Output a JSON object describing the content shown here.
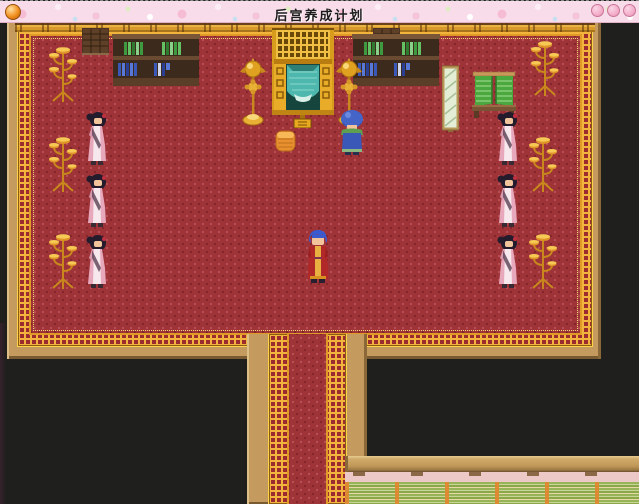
{
  "window": {
    "title": "后宫养成计划"
  },
  "palette": {
    "titlebar_pink": "#f9dcea",
    "ball_orange": "#f29020",
    "carpet_red": "#9e3338",
    "gold_trim": "#f2b43c",
    "wall_tan": "#c49a5e",
    "void_black": "#1f1f1d",
    "curtain_teal": "#4fb8ae",
    "mat_green": "#98b458",
    "lower_wall_pink": "#ecc9c6",
    "post_orange": "#e08830"
  },
  "scene": {
    "name": "palace-hall-interior",
    "entities": [
      {
        "type": "wallpanel",
        "name": "wall-panel",
        "x": 82,
        "y": 5
      },
      {
        "type": "wallpanel",
        "name": "wall-panel",
        "x": 373,
        "y": 5
      },
      {
        "type": "bookshelf",
        "name": "bookshelf",
        "x": 112,
        "y": 11
      },
      {
        "type": "bookshelf",
        "name": "bookshelf",
        "x": 352,
        "y": 11
      },
      {
        "type": "shrine",
        "name": "altar-shrine",
        "x": 272,
        "y": 5
      },
      {
        "type": "goldlamp",
        "name": "golden-lamp",
        "x": 240,
        "y": 35
      },
      {
        "type": "goldlamp",
        "name": "golden-lamp",
        "x": 336,
        "y": 35
      },
      {
        "type": "mirror",
        "name": "standing-mirror",
        "x": 442,
        "y": 41
      },
      {
        "type": "rack",
        "name": "clothes-rack",
        "x": 472,
        "y": 48
      },
      {
        "type": "candelabra",
        "name": "candelabra",
        "x": 46,
        "y": 21
      },
      {
        "type": "candelabra",
        "name": "candelabra",
        "x": 528,
        "y": 15
      },
      {
        "type": "candelabra",
        "name": "candelabra",
        "x": 46,
        "y": 111
      },
      {
        "type": "candelabra",
        "name": "candelabra",
        "x": 526,
        "y": 111
      },
      {
        "type": "candelabra",
        "name": "candelabra",
        "x": 46,
        "y": 208
      },
      {
        "type": "candelabra",
        "name": "candelabra",
        "x": 526,
        "y": 208
      },
      {
        "type": "maid",
        "name": "palace-maid",
        "x": 85,
        "y": 88
      },
      {
        "type": "maid",
        "name": "palace-maid",
        "x": 496,
        "y": 88
      },
      {
        "type": "maid",
        "name": "palace-maid",
        "x": 85,
        "y": 150
      },
      {
        "type": "maid",
        "name": "palace-maid",
        "x": 496,
        "y": 150
      },
      {
        "type": "maid",
        "name": "palace-maid",
        "x": 85,
        "y": 211
      },
      {
        "type": "maid",
        "name": "palace-maid",
        "x": 496,
        "y": 211
      },
      {
        "type": "cushion",
        "name": "floor-cushion",
        "x": 275,
        "y": 106
      },
      {
        "type": "attendant",
        "name": "attendant-npc",
        "x": 338,
        "y": 86
      },
      {
        "type": "emperor",
        "name": "player-character",
        "x": 305,
        "y": 206
      }
    ]
  }
}
